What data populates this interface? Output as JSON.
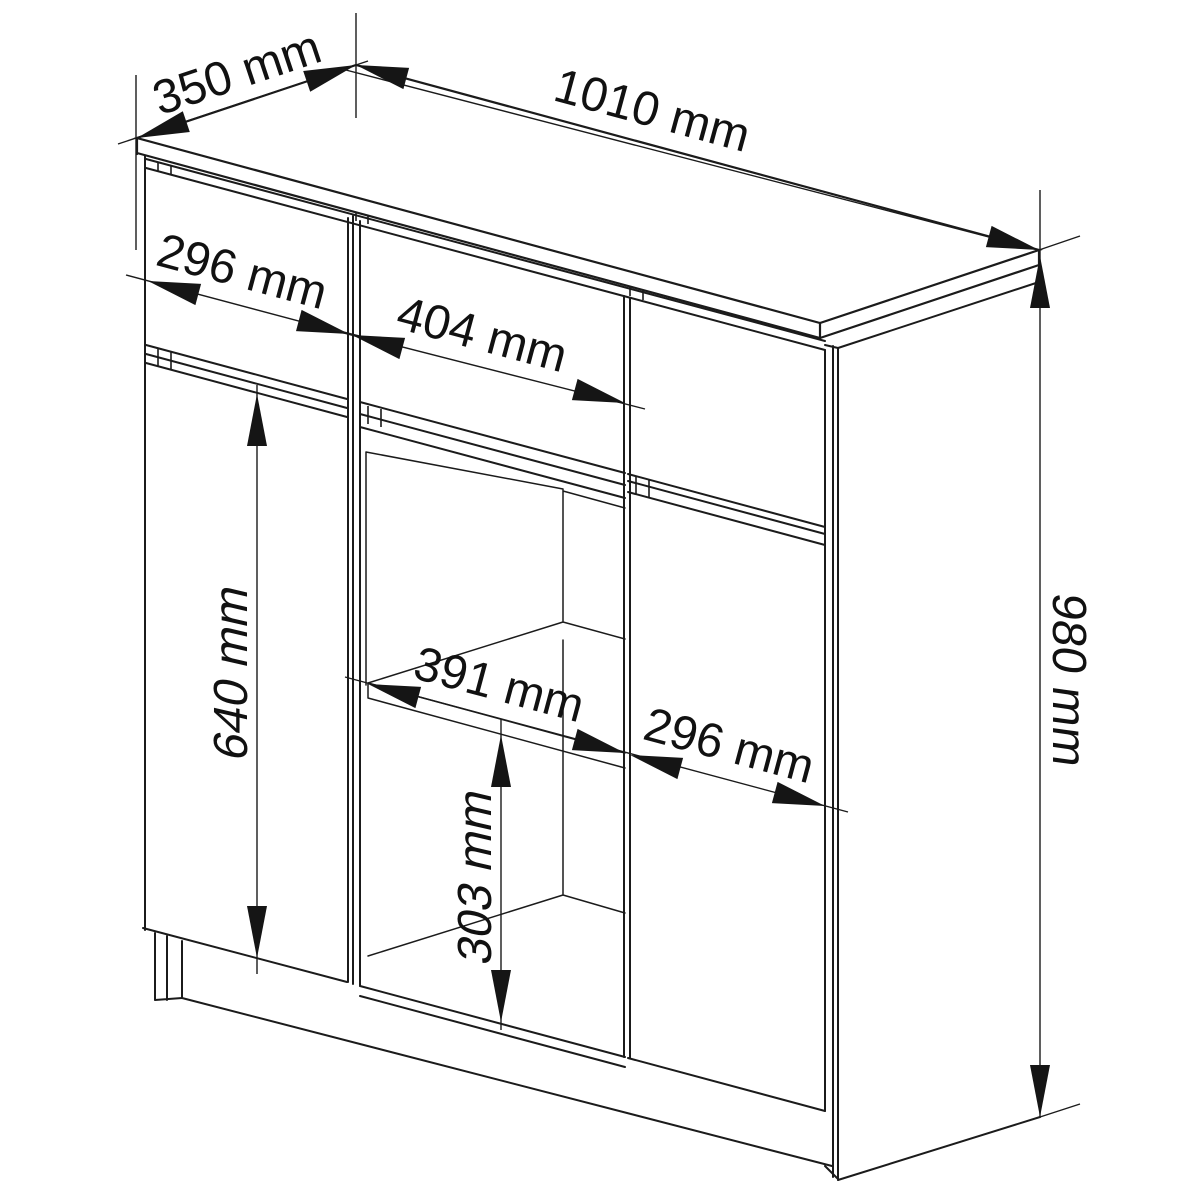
{
  "diagram": {
    "unit": "mm",
    "colors": {
      "line": "#1b1b1b",
      "background": "#ffffff",
      "text": "#111111"
    },
    "dimensions": [
      {
        "id": "top-depth",
        "value": 350,
        "unit": "mm",
        "label": "350 mm"
      },
      {
        "id": "top-width",
        "value": 1010,
        "unit": "mm",
        "label": "1010 mm"
      },
      {
        "id": "left-drawer-width",
        "value": 296,
        "unit": "mm",
        "label": "296 mm"
      },
      {
        "id": "middle-drawer-width",
        "value": 404,
        "unit": "mm",
        "label": "404 mm"
      },
      {
        "id": "left-door-height",
        "value": 640,
        "unit": "mm",
        "label": "640 mm"
      },
      {
        "id": "shelf-opening-width",
        "value": 391,
        "unit": "mm",
        "label": "391 mm"
      },
      {
        "id": "right-door-width",
        "value": 296,
        "unit": "mm",
        "label": "296 mm"
      },
      {
        "id": "shelf-opening-height",
        "value": 303,
        "unit": "mm",
        "label": "303 mm"
      },
      {
        "id": "total-height",
        "value": 980,
        "unit": "mm",
        "label": "980 mm"
      }
    ]
  }
}
